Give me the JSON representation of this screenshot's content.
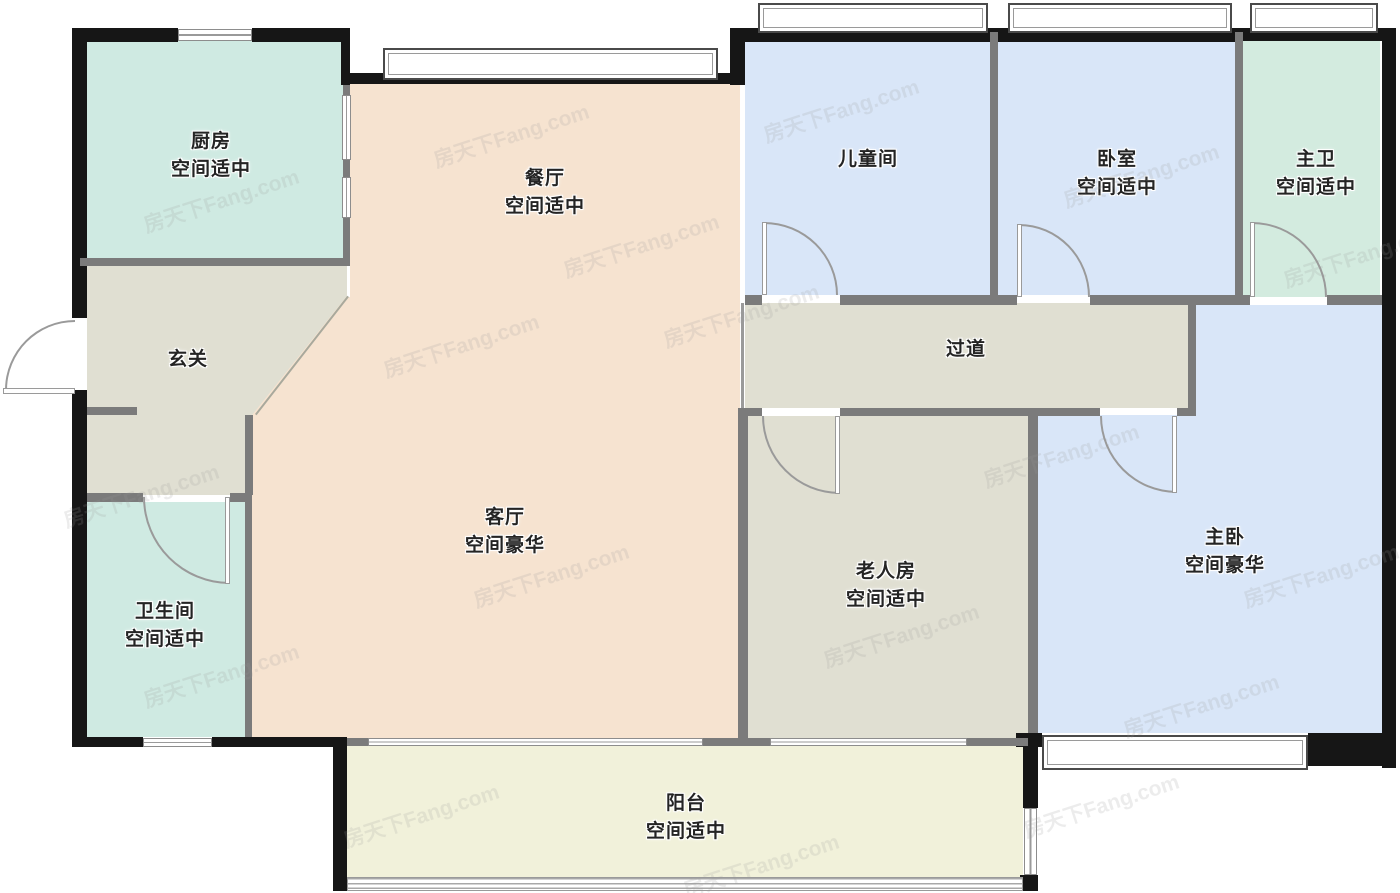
{
  "watermark": {
    "text": "房天下Fang.com"
  },
  "rooms": {
    "kitchen": {
      "name": "厨房",
      "size": "空间适中"
    },
    "dining": {
      "name": "餐厅",
      "size": "空间适中"
    },
    "children": {
      "name": "儿童间",
      "size": ""
    },
    "bedroom": {
      "name": "卧室",
      "size": "空间适中"
    },
    "master_bath": {
      "name": "主卫",
      "size": "空间适中"
    },
    "entry": {
      "name": "玄关",
      "size": ""
    },
    "hallway": {
      "name": "过道",
      "size": ""
    },
    "living": {
      "name": "客厅",
      "size": "空间豪华"
    },
    "elder": {
      "name": "老人房",
      "size": "空间适中"
    },
    "master_bed": {
      "name": "主卧",
      "size": "空间豪华"
    },
    "bathroom": {
      "name": "卫生间",
      "size": "空间适中"
    },
    "balcony": {
      "name": "阳台",
      "size": "空间适中"
    }
  },
  "colors": {
    "kitchen": "#cfeae2",
    "bathroom": "#cfeae2",
    "master_bath": "#d3ebdf",
    "dining_living": "#f6e3d0",
    "blue_room": "#d9e6f8",
    "gray_room": "#e0dfd2",
    "balcony": "#f1f1da",
    "wall_black": "#161616",
    "wall_gray": "#7b7b7b"
  }
}
